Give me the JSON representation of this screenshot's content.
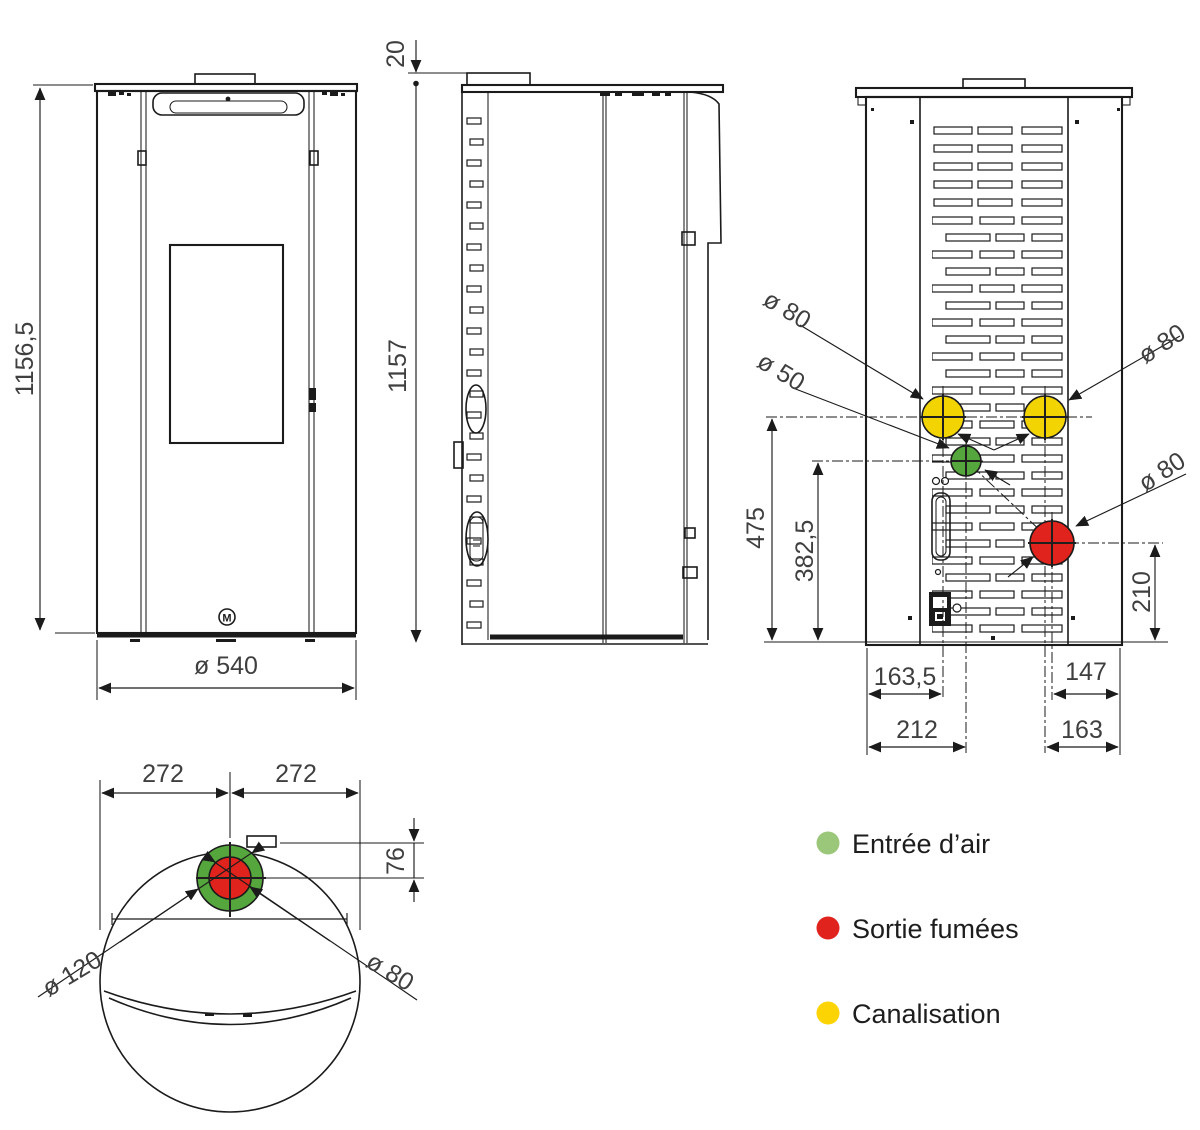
{
  "colors": {
    "line": "#1b1b1b",
    "dim_text": "#3f3f3f",
    "port_yellow": "#F3D403",
    "port_green": "#55A63C",
    "port_red": "#E0231C"
  },
  "front_view": {
    "height": "1156,5",
    "width": "ø 540",
    "logo_letter": "M"
  },
  "side_view": {
    "top_thickness": "20",
    "height": "1157"
  },
  "rear_view": {
    "duct_left": "ø 80",
    "air_inlet": "ø 50",
    "duct_right": "ø 80",
    "flue": "ø 80",
    "h_ducts": "475",
    "h_air_inlet": "382,5",
    "h_flue": "210",
    "x_duct_left": "163,5",
    "x_air_inlet": "212",
    "x_flue": "147",
    "x_duct_right": "163"
  },
  "top_view": {
    "half_left": "272",
    "half_right": "272",
    "offset_front": "76",
    "outer_dia": "ø 120",
    "inner_dia": "ø 80"
  },
  "legend": {
    "items": [
      {
        "label": "Entrée d’air",
        "color": "#9BC77B"
      },
      {
        "label": "Sortie fumées",
        "color": "#E0231C"
      },
      {
        "label": "Canalisation",
        "color": "#FCD403"
      }
    ]
  }
}
